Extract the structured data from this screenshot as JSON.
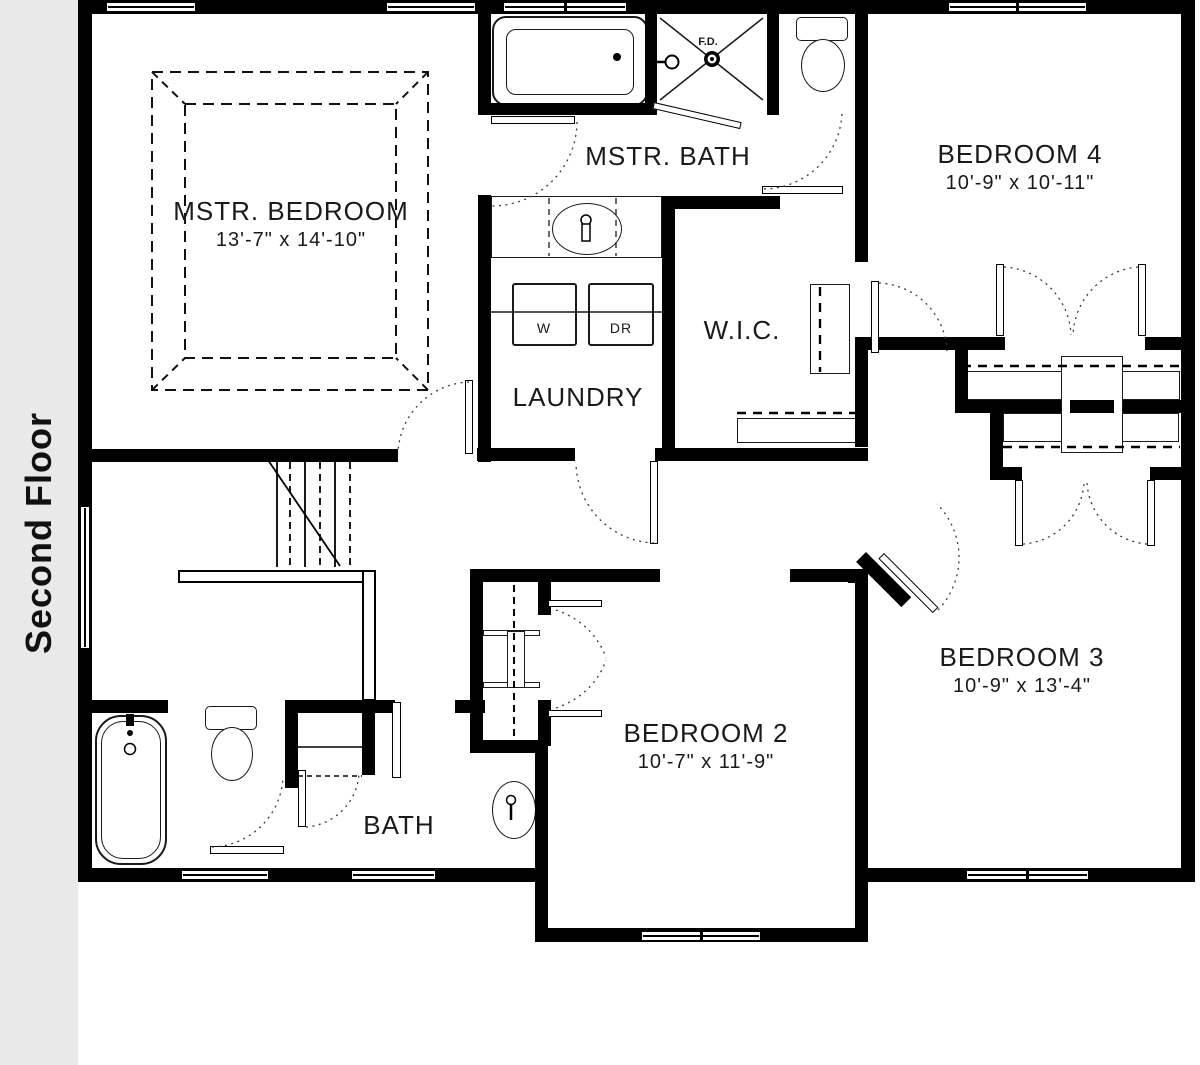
{
  "sidebar": {
    "label": "Second Floor"
  },
  "rooms": {
    "master_bedroom": {
      "name": "MSTR. BEDROOM",
      "dims": "13'-7\" x 14'-10\""
    },
    "master_bath": {
      "name": "MSTR. BATH"
    },
    "bedroom_4": {
      "name": "BEDROOM 4",
      "dims": "10'-9\" x 10'-11\""
    },
    "wic": {
      "name": "W.I.C."
    },
    "laundry": {
      "name": "LAUNDRY"
    },
    "bedroom_2": {
      "name": "BEDROOM 2",
      "dims": "10'-7\" x 11'-9\""
    },
    "bedroom_3": {
      "name": "BEDROOM 3",
      "dims": "10'-9\" x 13'-4\""
    },
    "bath": {
      "name": "BATH"
    }
  },
  "labels": {
    "washer": "W",
    "dryer": "DR",
    "floor_drain": "F.D."
  },
  "colors": {
    "wall": "#000000",
    "text": "#1a1a1a",
    "sidebar_bg": "#e9e9e9",
    "floor": "#ffffff"
  }
}
